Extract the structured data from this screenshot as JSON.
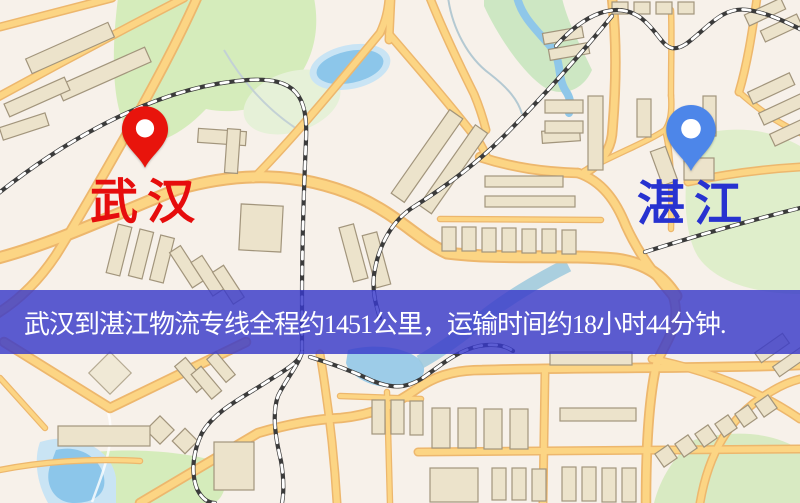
{
  "banner": {
    "text": "武汉到湛江物流专线全程约1451公里，运输时间约18小时44分钟.",
    "background": "#3839c9",
    "opacity": 0.82,
    "text_color": "#ffffff"
  },
  "markers": {
    "origin": {
      "label": "武汉",
      "label_color": "#e60d0d",
      "pin_color": "#e8140c"
    },
    "destination": {
      "label": "湛江",
      "label_color": "#2732d0",
      "pin_color": "#4d86e9"
    }
  },
  "map_colors": {
    "background": "#f7f1ea",
    "road_fill": "#fcd584",
    "road_casing": "#edb76d",
    "building": "#ece3cb",
    "park": "#d5ecbb",
    "water": "#8cc6ea",
    "railway": "#3b3b3b"
  }
}
